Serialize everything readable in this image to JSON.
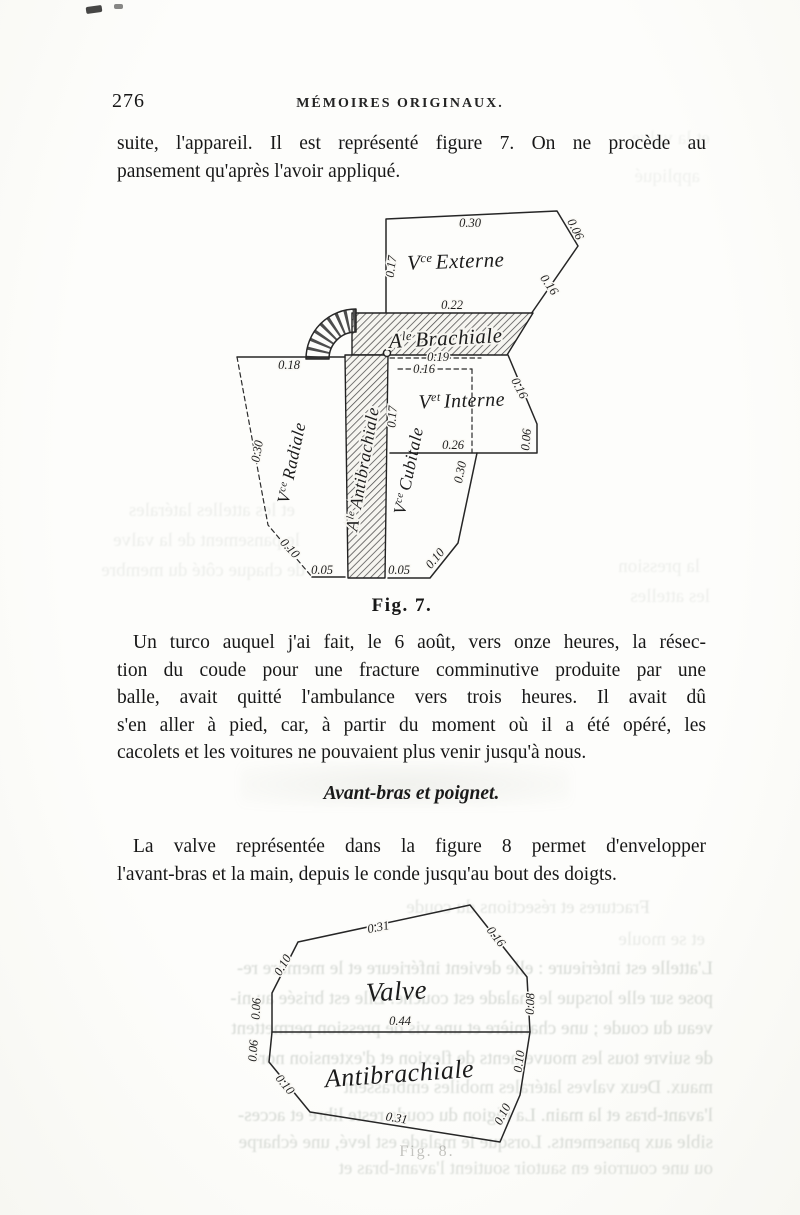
{
  "header": {
    "page_number": "276",
    "title": "MÉMOIRES ORIGINAUX."
  },
  "intro": {
    "line1": "suite, l'appareil. Il est représenté figure 7. On ne procède au",
    "line2": "pansement qu'après l'avoir appliqué."
  },
  "figure7": {
    "caption": "Fig. 7.",
    "labels": {
      "externe": {
        "prefix": "V",
        "sup": "ce",
        "name": "Externe"
      },
      "brachiale": {
        "prefix": "A",
        "sup": "le",
        "name": "Brachiale"
      },
      "interne": {
        "prefix": "V",
        "sup": "et",
        "name": "Interne"
      },
      "radiale": {
        "prefix": "V",
        "sup": "ce",
        "name": "Radiale"
      },
      "antibrachiale": {
        "prefix": "A",
        "sup": "le",
        "name": "Antibrachiale"
      },
      "cubitale": {
        "prefix": "V",
        "sup": "ce",
        "name": "Cubitale"
      }
    },
    "dims": {
      "externe_top": "0.30",
      "externe_corner": "0.06",
      "externe_side": "0.17",
      "externe_slant": "0.16",
      "brachiale_width": "0.22",
      "interne_gap": "0.19",
      "interne_top": "0.16",
      "radiale_top": "0.18",
      "radiale_side": "0.30",
      "radiale_slant": "0.10",
      "radiale_bottom": "0.05",
      "cubitale_side": "0.17",
      "interne_bottom": "0.26",
      "cubitale_right": "0.30",
      "interne_slant": "0.16",
      "interne_side": "0.06",
      "cubitale_bottom": "0.05",
      "cubitale_slant": "0.10"
    }
  },
  "turco": {
    "line1": "Un turco auquel j'ai fait, le 6 août, vers onze heures, la résec-",
    "line2": "tion du coude pour une fracture comminutive produite par une",
    "line3": "balle, avait quitté l'ambulance vers trois heures. Il avait dû",
    "line4": "s'en aller à pied, car, à partir du moment où il a été opéré, les",
    "line5": "cacolets et les voitures ne pouvaient plus venir jusqu'à nous."
  },
  "section": {
    "heading": "Avant-bras et poignet."
  },
  "valve_para": {
    "line1": "La valve représentée dans la figure 8 permet d'envelopper",
    "line2": "l'avant-bras et la main, depuis le conde jusqu'au bout des doigts."
  },
  "figure8": {
    "caption": "Fig. 8.",
    "labels": {
      "valve": "Valve",
      "antibrachiale": "Antibrachiale"
    },
    "dims": {
      "valve_top": "0.31",
      "valve_slant_right": "0.16",
      "valve_slant_left": "0.10",
      "valve_left": "0.06",
      "valve_right": "0.08",
      "valve_bottom": "0.44",
      "anti_left": "0.06",
      "anti_slant_left": "0.10",
      "anti_bottom": "0.31",
      "anti_slant_right": "0.10",
      "anti_right": "0.10"
    }
  },
  "bleedthrough": {
    "lines": [
      "Fractures et résections du coude",
      "et se moule",
      "L'attelle est intérieure : elle devient inférieure et le membre re-",
      "pose sur elle lorsque le malade est couché. Elle est brisée au ni-",
      "veau du coude ; une charnière et une vis de pression permettent",
      "de suivre tous les mouvements de flexion et d'extension nor-",
      "maux. Deux valves latérales mobiles embrassent",
      "l'avant-bras et la main. La région du coude reste libre et acces-",
      "sible aux pansements. Lorsque le malade est levé, une écharpe",
      "ou une courroie en sautoir soutient l'avant-bras et",
      "et les attelles latérales",
      "le pansement de la valve",
      "de chaque côté du membre",
      "la pression",
      "les attelles",
      "appliqué",
      "et la valve"
    ]
  }
}
